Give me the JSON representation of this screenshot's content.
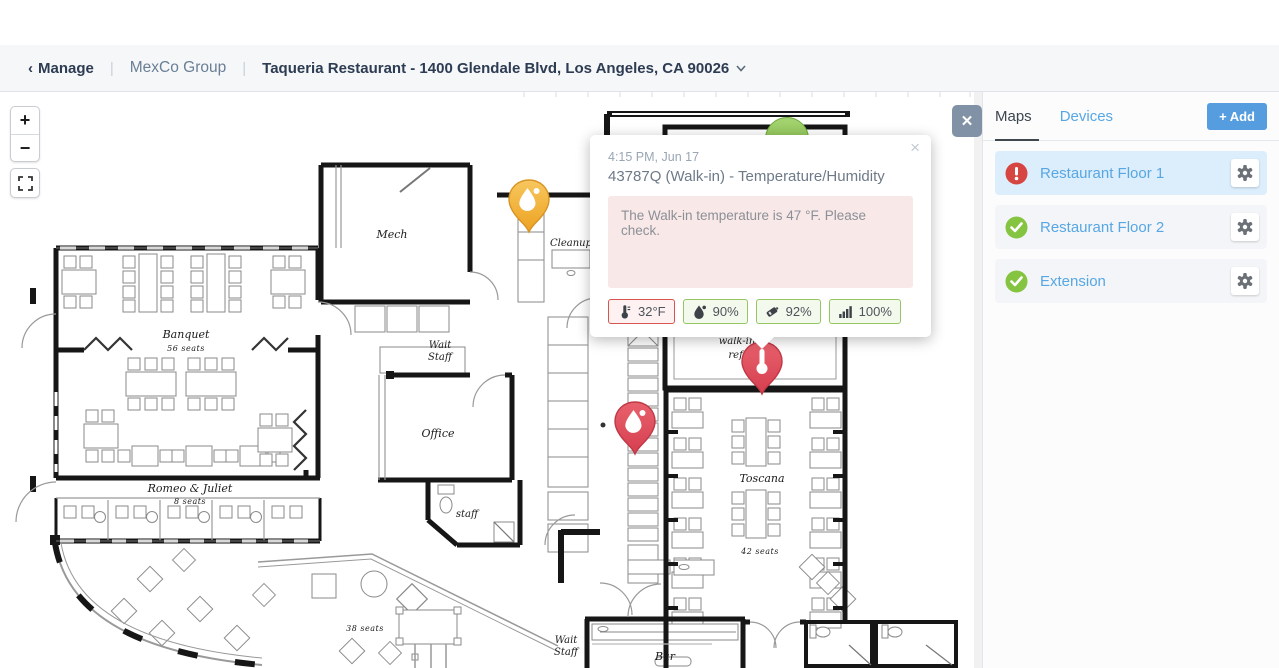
{
  "header": {
    "back_chevron": "‹",
    "back_label": "Manage",
    "divider": "|",
    "group": "MexCo Group",
    "location": "Taqueria Restaurant - 1400 Glendale Blvd, Los Angeles, CA 90026"
  },
  "map": {
    "controls": {
      "zoom_in": "+",
      "zoom_out": "−",
      "close": "✕"
    },
    "popup": {
      "close": "×",
      "timestamp": "4:15 PM, Jun 17",
      "title": "43787Q (Walk-in) - Temperature/Humidity",
      "message": "The Walk-in temperature is 47 °F. Please check.",
      "metrics": [
        {
          "name": "temperature",
          "value": "32°F",
          "status": "alert"
        },
        {
          "name": "humidity",
          "value": "90%",
          "status": "ok"
        },
        {
          "name": "battery",
          "value": "92%",
          "status": "ok"
        },
        {
          "name": "signal",
          "value": "100%",
          "status": "ok"
        }
      ]
    },
    "pins": [
      {
        "type": "water-sensor-warning",
        "color": "#eda221",
        "location": "cleanup-area"
      },
      {
        "type": "water-sensor-alert",
        "color": "#d63f50",
        "location": "kitchen-line"
      },
      {
        "type": "temperature-sensor-alert",
        "color": "#d63f50",
        "location": "walk-in"
      },
      {
        "type": "sensor-ok",
        "color": "#7cb93e",
        "location": "walk-in-top"
      }
    ],
    "floorplan": {
      "rooms": {
        "mech": "Mech",
        "cleanup": "Cleanup",
        "banquet": "Banquet",
        "banquet_seats": "56 seats",
        "wait1a": "Wait",
        "wait1b": "Staff",
        "office": "Office",
        "romeo": "Romeo & Juliet",
        "romeo_seats": "8 seats",
        "staff": "staff",
        "walkin1": "walk-in",
        "walkin2": "ref.",
        "toscana": "Toscana",
        "toscana_seats": "42 seats",
        "lounge_seats": "38 seats",
        "wait2a": "Wait",
        "wait2b": "Staff",
        "bar": "Bar"
      }
    }
  },
  "panel": {
    "tabs": [
      {
        "label": "Maps"
      },
      {
        "label": "Devices"
      }
    ],
    "add_plus": "+",
    "add_label": "Add",
    "items": [
      {
        "label": "Restaurant Floor 1",
        "status": "alert"
      },
      {
        "label": "Restaurant Floor 2",
        "status": "ok"
      },
      {
        "label": "Extension",
        "status": "ok"
      }
    ]
  },
  "colors": {
    "accent_blue": "#57a7e3",
    "alert_red": "#d64541",
    "ok_green": "#85c441",
    "add_button": "#569ddf",
    "pin_orange": "#eda221",
    "pin_red": "#d63f50"
  }
}
